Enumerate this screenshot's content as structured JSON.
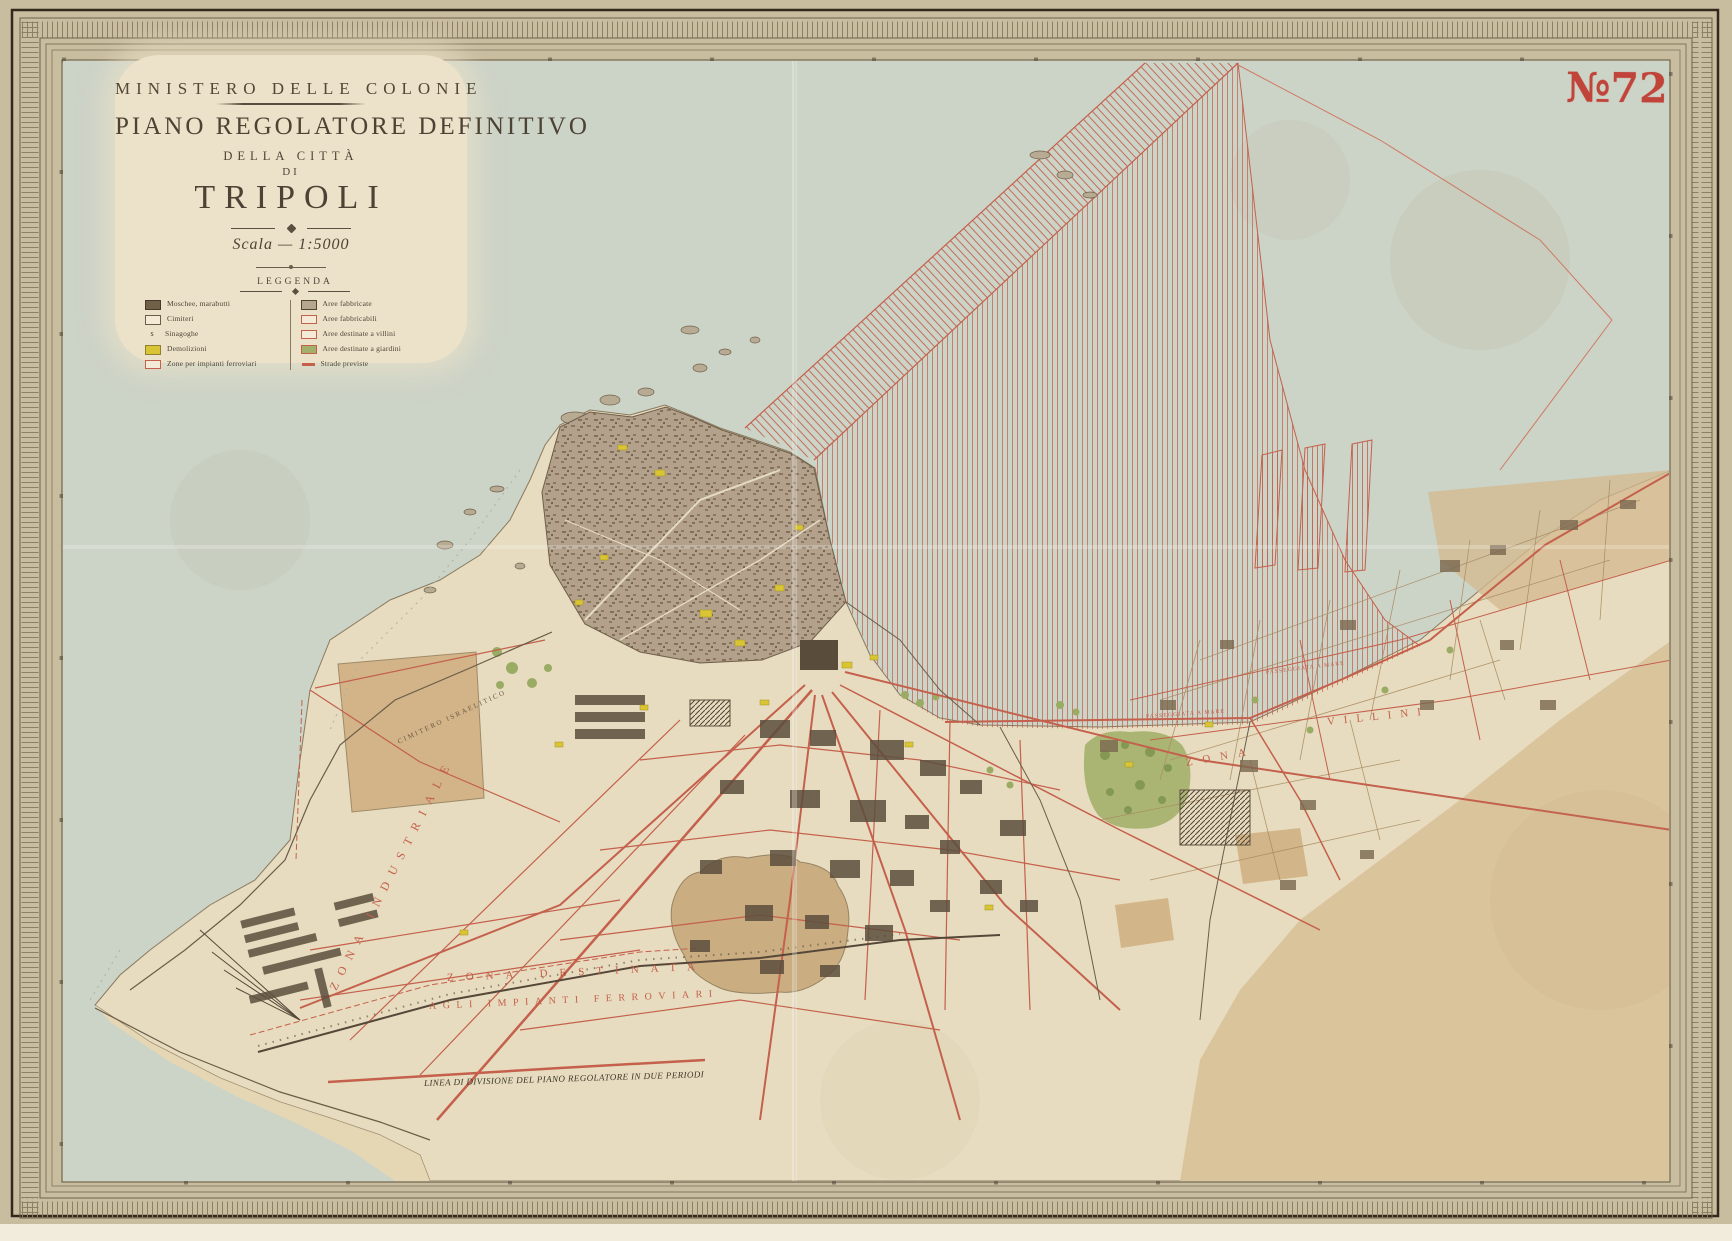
{
  "stamp": {
    "number": "№72"
  },
  "title_block": {
    "ministry": "MINISTERO DELLE COLONIE",
    "title": "PIANO REGOLATORE DEFINITIVO",
    "subtitle1": "DELLA CITTÀ",
    "subtitle2": "DI",
    "city": "TRIPOLI",
    "scale": "Scala — 1:5000"
  },
  "legend": {
    "title": "LEGGENDA",
    "left": [
      {
        "swatch": "dark-filled",
        "label": "Moschee, marabutti"
      },
      {
        "swatch": "white-outline",
        "label": "Cimiteri"
      },
      {
        "swatch": "symbol",
        "label": "Sinagoghe"
      },
      {
        "swatch": "yellow-filled",
        "label": "Demolizioni"
      },
      {
        "swatch": "red-outline",
        "label": "Zone per impianti ferroviari"
      }
    ],
    "right": [
      {
        "swatch": "gray-filled",
        "label": "Aree fabbricate"
      },
      {
        "swatch": "red-outline",
        "label": "Aree fabbricabili"
      },
      {
        "swatch": "red-outline",
        "label": "Aree destinate a villini"
      },
      {
        "swatch": "green-filled",
        "label": "Aree destinate a giardini"
      },
      {
        "swatch": "red-line",
        "label": "Strade previste"
      }
    ],
    "symbol_glyph": "s"
  },
  "labels": {
    "zona_destinata_1": "ZONA DESTINATA",
    "zona_destinata_2": "AGLI IMPIANTI FERROVIARI",
    "divisione": "LINEA DI DIVISIONE DEL PIANO REGOLATORE IN DUE PERIODI",
    "industriale": "ZONA INDUSTRIALE",
    "zona": "ZONA",
    "villini": "VILLINI",
    "passeggiata": "PASSEGGIATA A MARE",
    "cimitero": "CIMITERO ISRAELITICO"
  },
  "colors": {
    "paper": "#c9bda0",
    "panel": "#ece2c9",
    "sea": "#ccd3c7",
    "land": "#e7dcbf",
    "desert": "#d9c49c",
    "medina": "#b3a18c",
    "road_red": "#c4604c",
    "hatch_red": "#c4604c",
    "stamp_red": "#c13a30",
    "yellow": "#d9c433",
    "green": "#a3b06c",
    "tan": "#d2b286",
    "ink": "#4d4436"
  }
}
